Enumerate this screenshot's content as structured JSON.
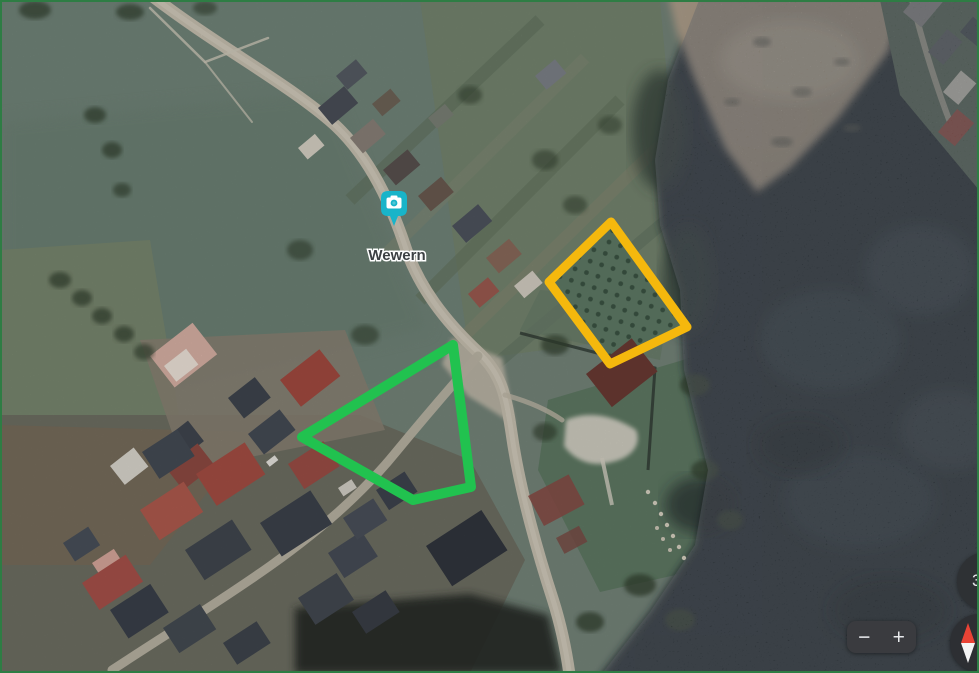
{
  "map": {
    "place_label": "Wewern",
    "marker": {
      "icon": "photo-camera-marker-icon",
      "color": "#18b4c9"
    }
  },
  "annotations": {
    "yellow_plot": {
      "color": "#f5b80d",
      "points": "611,222 549,282 610,364 687,327"
    },
    "green_plot": {
      "color": "#21c24f",
      "points": "453,345 302,437 413,500 471,487"
    }
  },
  "controls": {
    "zoom_out_label": "−",
    "zoom_in_label": "+",
    "badge_count": "3"
  }
}
